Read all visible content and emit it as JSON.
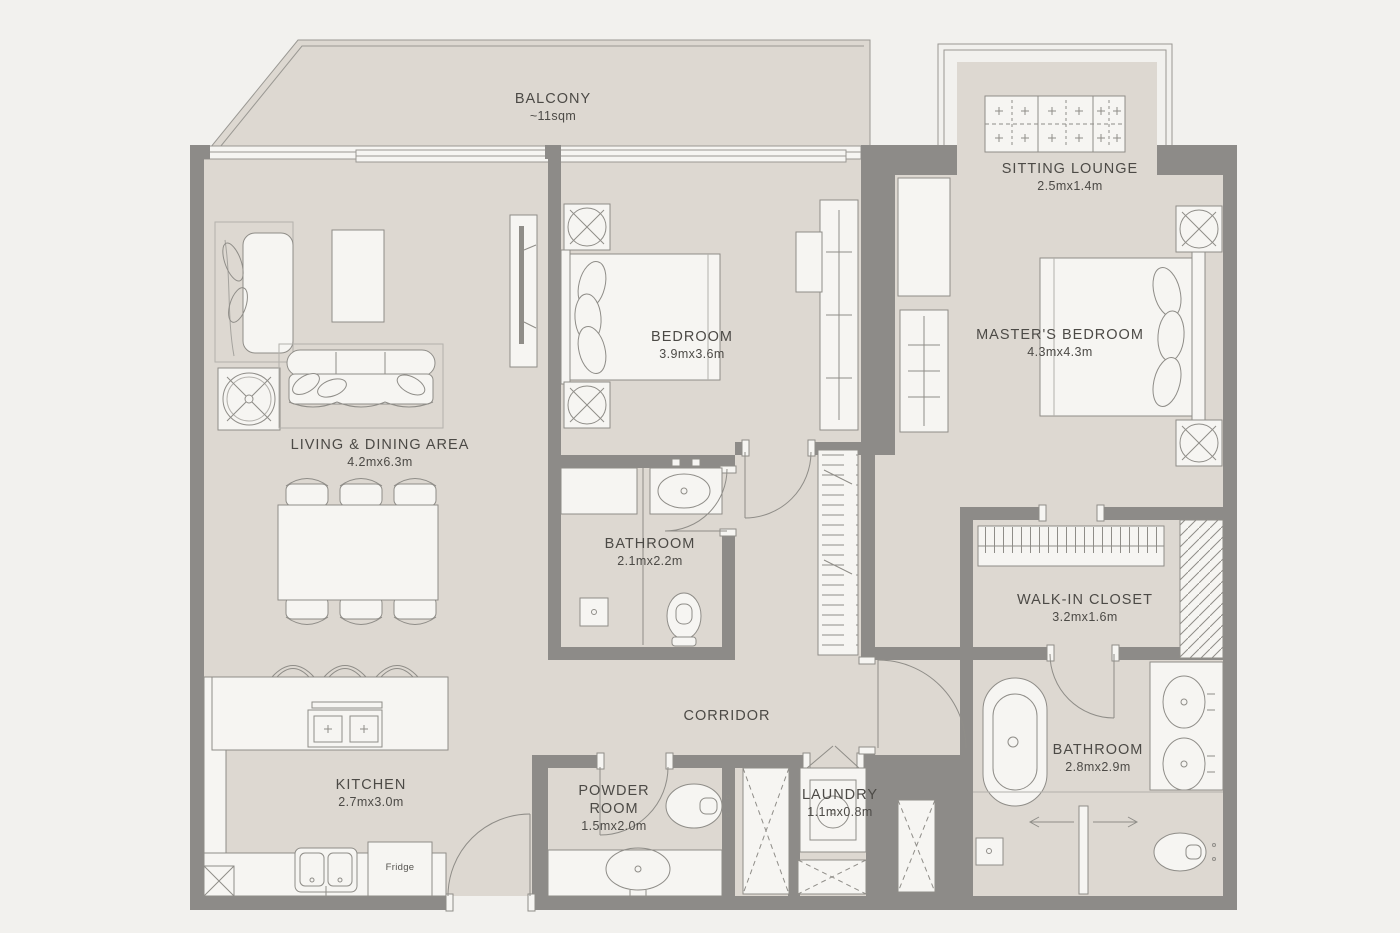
{
  "meta": {
    "type": "apartment floor plan"
  },
  "colors": {
    "background": "#f2f1ee",
    "floor": "#ddd8d1",
    "wall": "#8d8b88",
    "fixture_white": "#f6f5f2",
    "line": "#8f8d88",
    "text": "#4c4a46"
  },
  "rooms": {
    "balcony": {
      "name": "BALCONY",
      "dims": "~11sqm"
    },
    "sitting_lounge": {
      "name": "SITTING LOUNGE",
      "dims": "2.5mx1.4m"
    },
    "bedroom": {
      "name": "BEDROOM",
      "dims": "3.9mx3.6m"
    },
    "masters_bedroom": {
      "name": "MASTER'S BEDROOM",
      "dims": "4.3mx4.3m"
    },
    "living_dining": {
      "name": "LIVING & DINING AREA",
      "dims": "4.2mx6.3m"
    },
    "bathroom_shared": {
      "name": "BATHROOM",
      "dims": "2.1mx2.2m"
    },
    "walk_in_closet": {
      "name": "WALK-IN CLOSET",
      "dims": "3.2mx1.6m"
    },
    "corridor": {
      "name": "CORRIDOR",
      "dims": ""
    },
    "kitchen": {
      "name": "KITCHEN",
      "dims": "2.7mx3.0m"
    },
    "powder_room": {
      "name": "POWDER ROOM",
      "dims": "1.5mx2.0m"
    },
    "laundry": {
      "name": "LAUNDRY",
      "dims": "1.1mx0.8m"
    },
    "master_bathroom": {
      "name": "BATHROOM",
      "dims": "2.8mx2.9m"
    }
  },
  "appliances": {
    "fridge": "Fridge"
  }
}
